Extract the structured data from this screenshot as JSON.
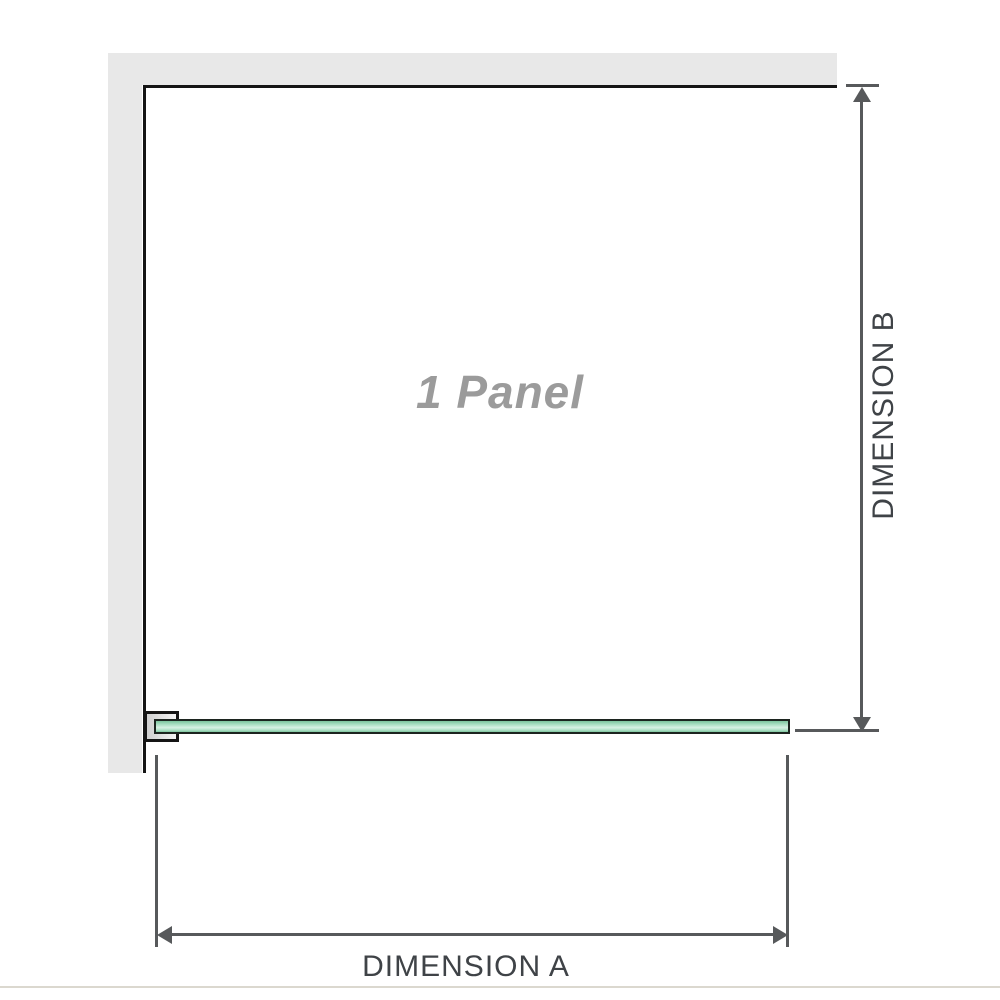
{
  "diagram": {
    "title": "1 Panel",
    "dimension_a_label": "DIMENSION A",
    "dimension_b_label": "DIMENSION B",
    "panel_count": 1,
    "elements": {
      "wall": "L-shaped wall at top-left",
      "glass_panel": "single glass panel in top view attached to wall by bracket",
      "bracket": "wall-mount clamp holding left end of glass panel"
    }
  },
  "colors": {
    "wall": "#e8e8e8",
    "outline": "#151515",
    "arrow": "#57595b",
    "label": "#3f4347",
    "title": "#9b9b9b",
    "glass-dark": "#7cc49d",
    "glass-mid": "#a9dec2",
    "glass-light": "#d8f1e4",
    "separator": "#dbd8cf"
  }
}
